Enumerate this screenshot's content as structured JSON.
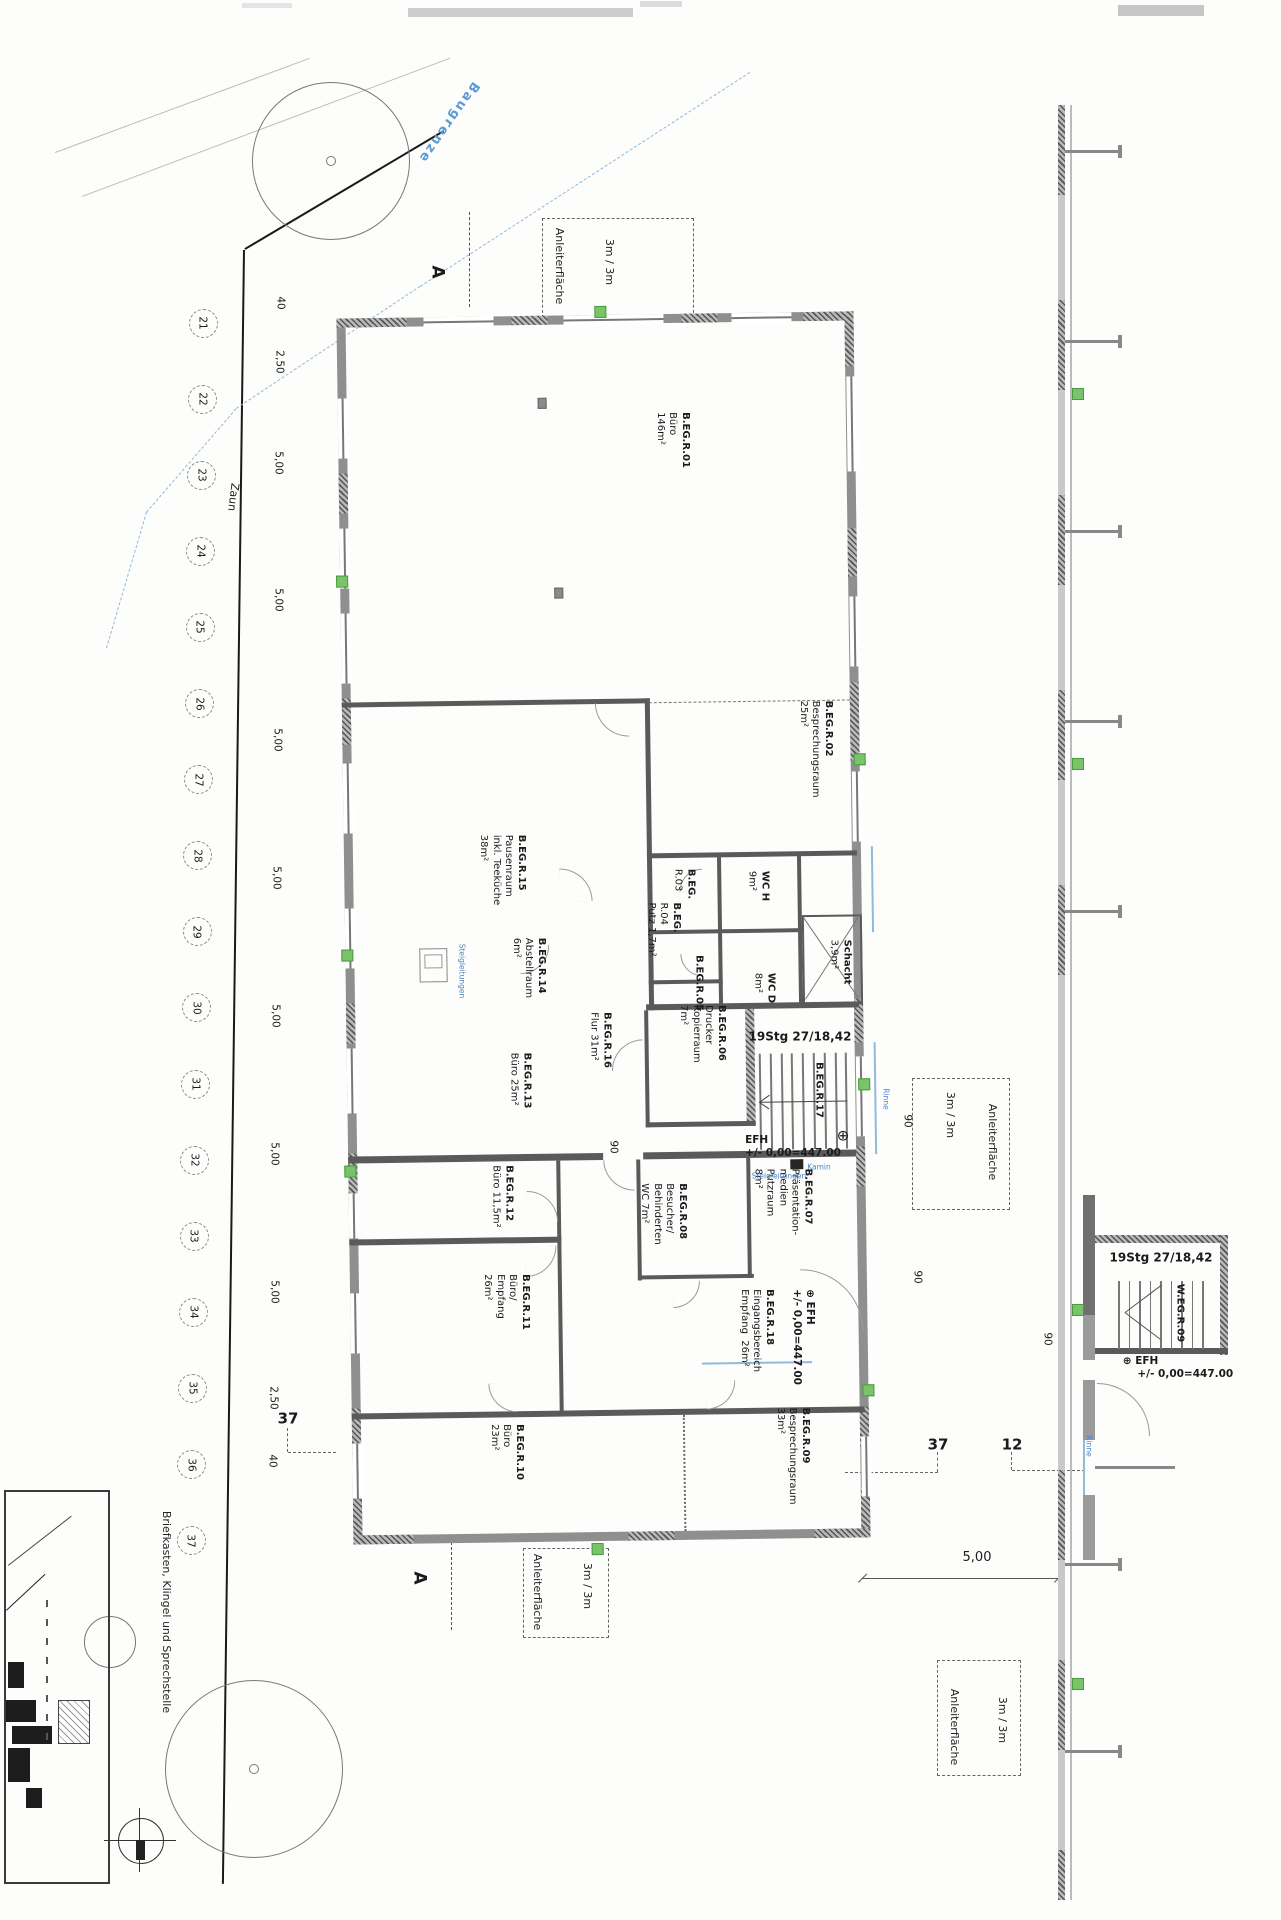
{
  "plan": {
    "axis": {
      "numbers": [
        "21",
        "22",
        "23",
        "24",
        "25",
        "26",
        "27",
        "28",
        "29",
        "30",
        "31",
        "32",
        "33",
        "34",
        "35",
        "36",
        "37"
      ]
    },
    "dimensions": {
      "left_chain": [
        "40",
        "2,50",
        "5,00",
        "5,00",
        "5,00",
        "5,00",
        "5,00",
        "5,00",
        "5,00",
        "2,50",
        "40"
      ],
      "bottom_right": "5,00",
      "door_widths": [
        "90",
        "90",
        "90",
        "90"
      ]
    },
    "rooms": [
      {
        "id": "r01",
        "lines": [
          "B.EG.R.01",
          "Büro",
          "146m²"
        ]
      },
      {
        "id": "r02",
        "lines": [
          "B.EG.R.02",
          "Besprechungsraum",
          "25m²"
        ]
      },
      {
        "id": "r15",
        "lines": [
          "B.EG.R.15",
          "Pausenraum",
          "inkl. Teeküche",
          "38m²"
        ]
      },
      {
        "id": "r14",
        "lines": [
          "B.EG.R.14",
          "Abstellraum",
          "6m²"
        ]
      },
      {
        "id": "r13",
        "lines": [
          "B.EG.R.13",
          "Büro 25m²"
        ]
      },
      {
        "id": "r16",
        "lines": [
          "B.EG.R.16",
          "Flur 31m²"
        ]
      },
      {
        "id": "r06",
        "lines": [
          "B.EG.R.06",
          "Drucker",
          "Kopierraum",
          "7m²"
        ]
      },
      {
        "id": "r03",
        "lines": [
          "B.EG.",
          "R.03"
        ]
      },
      {
        "id": "r04",
        "lines": [
          "B.EG.",
          "R.04",
          "Putz 1,7m²"
        ]
      },
      {
        "id": "r05",
        "lines": [
          "B.EG.R.05"
        ]
      },
      {
        "id": "wch",
        "lines": [
          "WC H",
          "9m²"
        ]
      },
      {
        "id": "wcd",
        "lines": [
          "WC D",
          "8m²"
        ]
      },
      {
        "id": "schacht",
        "lines": [
          "Schacht",
          "3,9m²"
        ]
      },
      {
        "id": "r17",
        "lines": [
          "B.EG.R.17"
        ]
      },
      {
        "id": "r08",
        "lines": [
          "B.EG.R.08",
          "Besucher/",
          "Behinderten",
          "WC 7m²"
        ]
      },
      {
        "id": "r07",
        "lines": [
          "B.EG.R.07",
          "Präsentation-",
          "medien",
          "Putzraum",
          "8m²"
        ]
      },
      {
        "id": "r12",
        "lines": [
          "B.EG.R.12",
          "Büro 11,5m²"
        ]
      },
      {
        "id": "r11",
        "lines": [
          "B.EG.R.11",
          "Büro/",
          "Empfang",
          "26m²"
        ]
      },
      {
        "id": "r18",
        "lines": [
          "B.EG.R.18",
          "Eingangsbereich",
          "Empfang  26m²"
        ]
      },
      {
        "id": "r10",
        "lines": [
          "B.EG.R.10",
          "Büro",
          "23m²"
        ]
      },
      {
        "id": "r09",
        "lines": [
          "B.EG.R.09",
          "Besprechungsraum",
          "33m²"
        ]
      },
      {
        "id": "weg09",
        "lines": [
          "W.EG.R.09"
        ]
      }
    ],
    "annotations": [
      {
        "id": "baugrenze",
        "text": "Baugrenze"
      },
      {
        "id": "zaun",
        "text": "Zaun"
      },
      {
        "id": "anl1a",
        "text": "Anleiterfläche"
      },
      {
        "id": "anl1b",
        "text": "3m / 3m"
      },
      {
        "id": "anl2a",
        "text": "Anleiterfläche"
      },
      {
        "id": "anl2b",
        "text": "3m / 3m"
      },
      {
        "id": "anl3a",
        "text": "Anleiterfläche"
      },
      {
        "id": "anl3b",
        "text": "3m / 3m"
      },
      {
        "id": "anl4a",
        "text": "Anleiterfläche"
      },
      {
        "id": "anl4b",
        "text": "3m / 3m"
      },
      {
        "id": "briefk",
        "text": "Briefkasten, Klingel und Sprechstelle"
      },
      {
        "id": "secA1",
        "text": "A"
      },
      {
        "id": "secA2",
        "text": "A"
      },
      {
        "id": "stg1",
        "text": "19Stg 27/18,42"
      },
      {
        "id": "stg2",
        "text": "19Stg 27/18,42"
      },
      {
        "id": "efh1",
        "text": "EFH\n+/- 0,00=447.00"
      },
      {
        "id": "sym1",
        "text": "⊕"
      },
      {
        "id": "efh2",
        "text": "⊕ EFH\n+/- 0,00=447.00"
      },
      {
        "id": "efh3",
        "text": "⊕ EFH\n    +/- 0,00=447.00"
      },
      {
        "id": "p37a",
        "text": "37"
      },
      {
        "id": "p37b",
        "text": "37"
      },
      {
        "id": "p12",
        "text": "12"
      },
      {
        "id": "d500b",
        "text": "5,00"
      },
      {
        "id": "n90a",
        "text": "90"
      },
      {
        "id": "n90b",
        "text": "90"
      },
      {
        "id": "n90c",
        "text": "90"
      },
      {
        "id": "n90d",
        "text": "90"
      },
      {
        "id": "st1",
        "text": "Steigleitungen"
      },
      {
        "id": "st2",
        "text": "Steigleitungen"
      },
      {
        "id": "kamin",
        "text": "Kamin"
      },
      {
        "id": "rinne1",
        "text": "Rinne"
      },
      {
        "id": "rinne2",
        "text": "Rinne"
      }
    ],
    "colors": {
      "wall_grey": "#8f8f8f",
      "hatch_dark": "#555555",
      "annotation_blue": "#4a86c8",
      "baugrenze_blue": "#5b9bd5",
      "marker_green": "#79c36a"
    }
  }
}
